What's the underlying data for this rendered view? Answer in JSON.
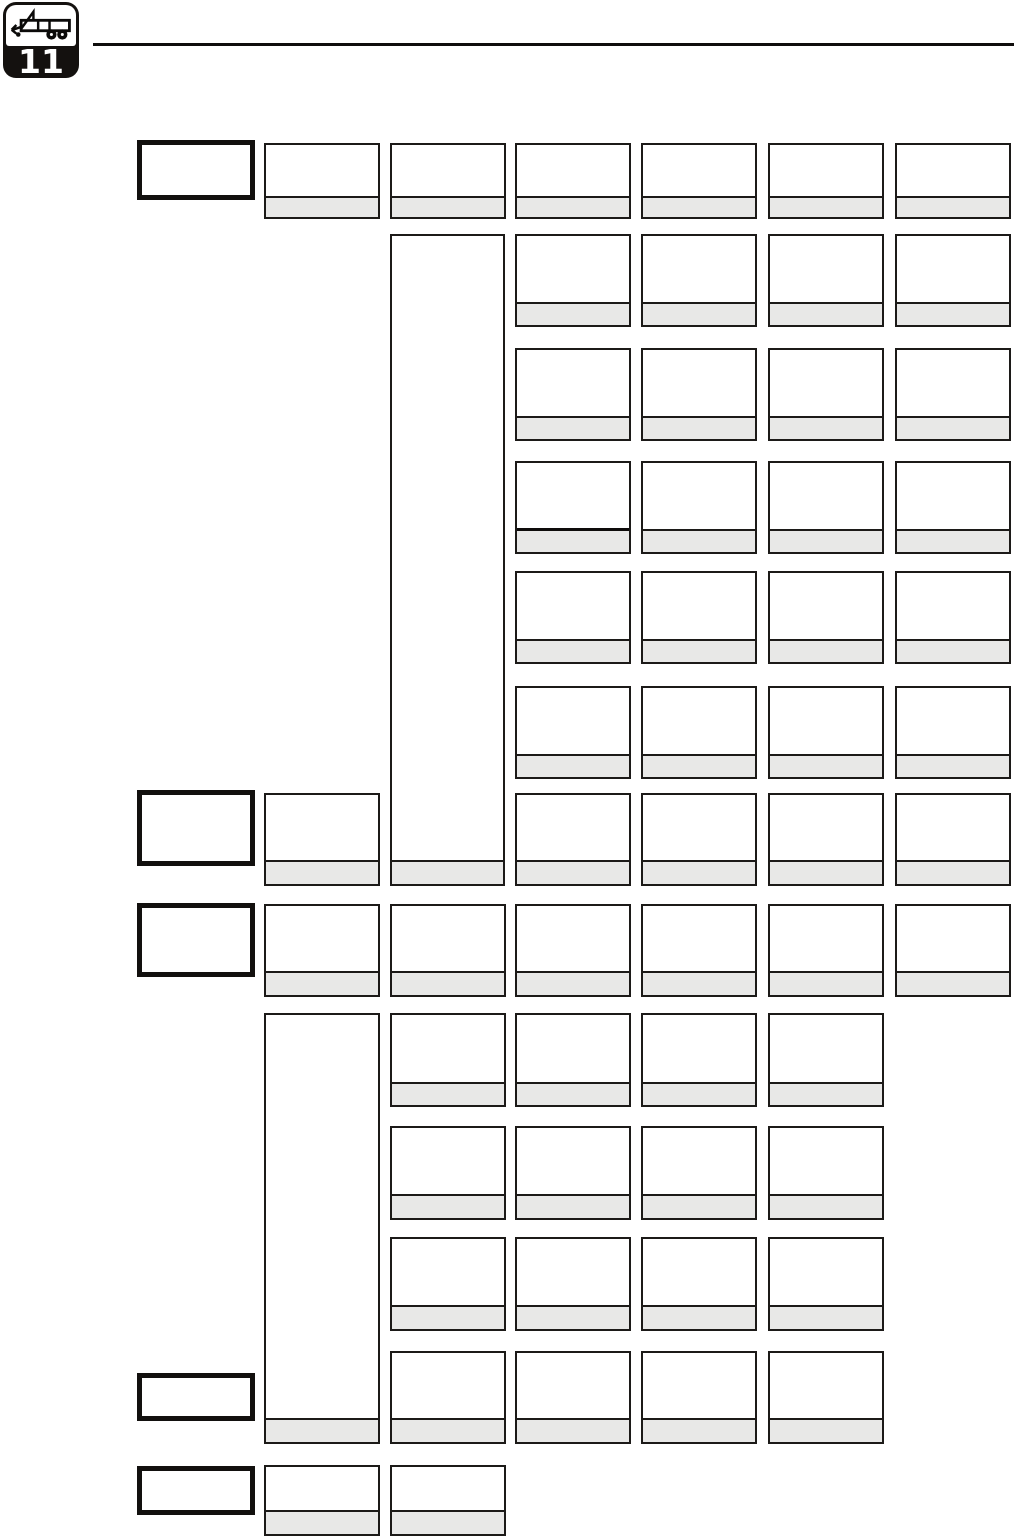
{
  "page": {
    "width": 1034,
    "height": 1538,
    "background": "#ffffff"
  },
  "chapter_badge": {
    "number": "11",
    "icon": "trailer-icon",
    "tile_color": "#14110f",
    "number_color": "#ffffff",
    "panel_color": "#ffffff"
  },
  "header_rule": {
    "color": "#0f0d0c"
  },
  "styles": {
    "box_border_color": "#1c1a18",
    "bold_border_color": "#12100e",
    "caption_fill": "#e8e8e7"
  },
  "boxes": [
    {
      "kind": "bold",
      "x": 137,
      "y": 140,
      "w": 118,
      "h": 60
    },
    {
      "kind": "bold",
      "x": 137,
      "y": 790,
      "w": 118,
      "h": 76
    },
    {
      "kind": "bold",
      "x": 137,
      "y": 903,
      "w": 118,
      "h": 74
    },
    {
      "kind": "bold",
      "x": 137,
      "y": 1373,
      "w": 118,
      "h": 48
    },
    {
      "kind": "bold",
      "x": 137,
      "y": 1466,
      "w": 118,
      "h": 49
    },
    {
      "kind": "captioned",
      "x": 264,
      "y": 143,
      "w": 116,
      "h": 76,
      "caption_h": 19
    },
    {
      "kind": "captioned",
      "x": 390,
      "y": 143,
      "w": 116,
      "h": 76,
      "caption_h": 19
    },
    {
      "kind": "captioned",
      "x": 515,
      "y": 143,
      "w": 116,
      "h": 76,
      "caption_h": 19
    },
    {
      "kind": "captioned",
      "x": 641,
      "y": 143,
      "w": 116,
      "h": 76,
      "caption_h": 19
    },
    {
      "kind": "captioned",
      "x": 768,
      "y": 143,
      "w": 116,
      "h": 76,
      "caption_h": 19
    },
    {
      "kind": "captioned",
      "x": 895,
      "y": 143,
      "w": 116,
      "h": 76,
      "caption_h": 19
    },
    {
      "kind": "captioned",
      "x": 390,
      "y": 234,
      "w": 115,
      "h": 652,
      "caption_h": 22
    },
    {
      "kind": "captioned",
      "x": 515,
      "y": 234,
      "w": 116,
      "h": 93,
      "caption_h": 21
    },
    {
      "kind": "captioned",
      "x": 641,
      "y": 234,
      "w": 116,
      "h": 93,
      "caption_h": 21
    },
    {
      "kind": "captioned",
      "x": 768,
      "y": 234,
      "w": 116,
      "h": 93,
      "caption_h": 21
    },
    {
      "kind": "captioned",
      "x": 895,
      "y": 234,
      "w": 116,
      "h": 93,
      "caption_h": 21
    },
    {
      "kind": "captioned",
      "x": 515,
      "y": 348,
      "w": 116,
      "h": 93,
      "caption_h": 21
    },
    {
      "kind": "captioned",
      "x": 641,
      "y": 348,
      "w": 116,
      "h": 93,
      "caption_h": 21
    },
    {
      "kind": "captioned",
      "x": 768,
      "y": 348,
      "w": 116,
      "h": 93,
      "caption_h": 21
    },
    {
      "kind": "captioned",
      "x": 895,
      "y": 348,
      "w": 116,
      "h": 93,
      "caption_h": 21
    },
    {
      "kind": "captioned",
      "x": 515,
      "y": 461,
      "w": 116,
      "h": 93,
      "caption_h": 21,
      "divider": "thick"
    },
    {
      "kind": "captioned",
      "x": 641,
      "y": 461,
      "w": 116,
      "h": 93,
      "caption_h": 21
    },
    {
      "kind": "captioned",
      "x": 768,
      "y": 461,
      "w": 116,
      "h": 93,
      "caption_h": 21
    },
    {
      "kind": "captioned",
      "x": 895,
      "y": 461,
      "w": 116,
      "h": 93,
      "caption_h": 21
    },
    {
      "kind": "captioned",
      "x": 515,
      "y": 571,
      "w": 116,
      "h": 93,
      "caption_h": 21
    },
    {
      "kind": "captioned",
      "x": 641,
      "y": 571,
      "w": 116,
      "h": 93,
      "caption_h": 21
    },
    {
      "kind": "captioned",
      "x": 768,
      "y": 571,
      "w": 116,
      "h": 93,
      "caption_h": 21
    },
    {
      "kind": "captioned",
      "x": 895,
      "y": 571,
      "w": 116,
      "h": 93,
      "caption_h": 21
    },
    {
      "kind": "captioned",
      "x": 515,
      "y": 686,
      "w": 116,
      "h": 93,
      "caption_h": 21
    },
    {
      "kind": "captioned",
      "x": 641,
      "y": 686,
      "w": 116,
      "h": 93,
      "caption_h": 21
    },
    {
      "kind": "captioned",
      "x": 768,
      "y": 686,
      "w": 116,
      "h": 93,
      "caption_h": 21
    },
    {
      "kind": "captioned",
      "x": 895,
      "y": 686,
      "w": 116,
      "h": 93,
      "caption_h": 21
    },
    {
      "kind": "captioned",
      "x": 264,
      "y": 793,
      "w": 116,
      "h": 93,
      "caption_h": 22
    },
    {
      "kind": "captioned",
      "x": 515,
      "y": 793,
      "w": 116,
      "h": 93,
      "caption_h": 22
    },
    {
      "kind": "captioned",
      "x": 641,
      "y": 793,
      "w": 116,
      "h": 93,
      "caption_h": 22
    },
    {
      "kind": "captioned",
      "x": 768,
      "y": 793,
      "w": 116,
      "h": 93,
      "caption_h": 22
    },
    {
      "kind": "captioned",
      "x": 895,
      "y": 793,
      "w": 116,
      "h": 93,
      "caption_h": 22
    },
    {
      "kind": "captioned",
      "x": 264,
      "y": 904,
      "w": 116,
      "h": 93,
      "caption_h": 22
    },
    {
      "kind": "captioned",
      "x": 390,
      "y": 904,
      "w": 116,
      "h": 93,
      "caption_h": 22
    },
    {
      "kind": "captioned",
      "x": 515,
      "y": 904,
      "w": 116,
      "h": 93,
      "caption_h": 22
    },
    {
      "kind": "captioned",
      "x": 641,
      "y": 904,
      "w": 116,
      "h": 93,
      "caption_h": 22
    },
    {
      "kind": "captioned",
      "x": 768,
      "y": 904,
      "w": 116,
      "h": 93,
      "caption_h": 22
    },
    {
      "kind": "captioned",
      "x": 895,
      "y": 904,
      "w": 116,
      "h": 93,
      "caption_h": 22
    },
    {
      "kind": "captioned",
      "x": 264,
      "y": 1013,
      "w": 116,
      "h": 431,
      "caption_h": 22
    },
    {
      "kind": "captioned",
      "x": 390,
      "y": 1013,
      "w": 116,
      "h": 94,
      "caption_h": 21
    },
    {
      "kind": "captioned",
      "x": 515,
      "y": 1013,
      "w": 116,
      "h": 94,
      "caption_h": 21
    },
    {
      "kind": "captioned",
      "x": 641,
      "y": 1013,
      "w": 116,
      "h": 94,
      "caption_h": 21
    },
    {
      "kind": "captioned",
      "x": 768,
      "y": 1013,
      "w": 116,
      "h": 94,
      "caption_h": 21
    },
    {
      "kind": "captioned",
      "x": 390,
      "y": 1126,
      "w": 116,
      "h": 94,
      "caption_h": 22
    },
    {
      "kind": "captioned",
      "x": 515,
      "y": 1126,
      "w": 116,
      "h": 94,
      "caption_h": 22
    },
    {
      "kind": "captioned",
      "x": 641,
      "y": 1126,
      "w": 116,
      "h": 94,
      "caption_h": 22
    },
    {
      "kind": "captioned",
      "x": 768,
      "y": 1126,
      "w": 116,
      "h": 94,
      "caption_h": 22
    },
    {
      "kind": "captioned",
      "x": 390,
      "y": 1237,
      "w": 116,
      "h": 94,
      "caption_h": 22
    },
    {
      "kind": "captioned",
      "x": 515,
      "y": 1237,
      "w": 116,
      "h": 94,
      "caption_h": 22
    },
    {
      "kind": "captioned",
      "x": 641,
      "y": 1237,
      "w": 116,
      "h": 94,
      "caption_h": 22
    },
    {
      "kind": "captioned",
      "x": 768,
      "y": 1237,
      "w": 116,
      "h": 94,
      "caption_h": 22
    },
    {
      "kind": "captioned",
      "x": 390,
      "y": 1351,
      "w": 116,
      "h": 93,
      "caption_h": 22
    },
    {
      "kind": "captioned",
      "x": 515,
      "y": 1351,
      "w": 116,
      "h": 93,
      "caption_h": 22
    },
    {
      "kind": "captioned",
      "x": 641,
      "y": 1351,
      "w": 116,
      "h": 93,
      "caption_h": 22
    },
    {
      "kind": "captioned",
      "x": 768,
      "y": 1351,
      "w": 116,
      "h": 93,
      "caption_h": 22
    },
    {
      "kind": "captioned",
      "x": 264,
      "y": 1465,
      "w": 116,
      "h": 71,
      "caption_h": 22
    },
    {
      "kind": "captioned",
      "x": 390,
      "y": 1465,
      "w": 116,
      "h": 71,
      "caption_h": 22
    }
  ]
}
